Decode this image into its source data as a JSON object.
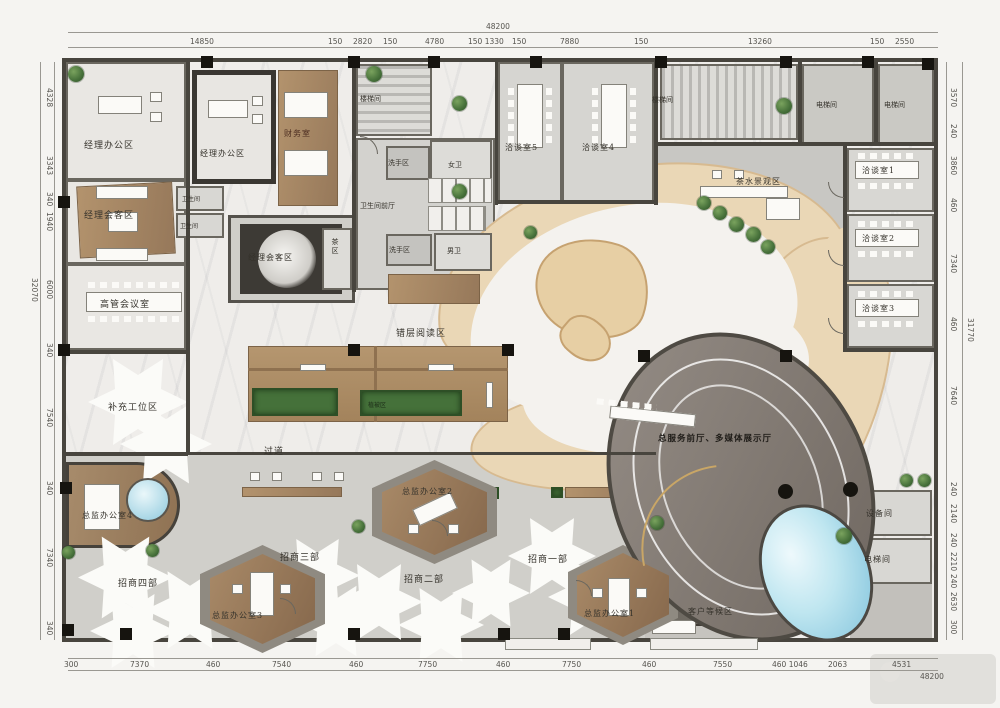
{
  "labels": {
    "manager_office_1": "经理办公区",
    "manager_office_2": "经理办公区",
    "finance_room": "财务室",
    "stair_left": "楼梯间",
    "wash_area_1": "洗手区",
    "womens_toilet": "女卫",
    "toilet_foyer": "卫生间前厅",
    "wash_area_2": "洗手区",
    "mens_toilet": "男卫",
    "meeting_room_5": "洽谈室5",
    "meeting_room_4": "洽谈室4",
    "stair_right": "楼梯间",
    "elevator_top_1": "电梯间",
    "elevator_top_2": "电梯间",
    "tea_landscape": "茶水景观区",
    "meeting_room_1": "洽谈室1",
    "meeting_room_2": "洽谈室2",
    "meeting_room_3": "洽谈室3",
    "manager_lounge_left": "经理会客区",
    "toilet_small_1": "卫生间",
    "toilet_small_2": "卫生间",
    "manager_lounge_center": "经理会客区",
    "tea_area": "茶区",
    "exec_meeting_room": "高管会议室",
    "reading_area": "错层阅读区",
    "vegetation": "植被区",
    "extra_workstations": "补充工位区",
    "corridor": "过道",
    "service_hall": "总服务前厅、多媒体展示厅",
    "director_office_4": "总监办公室4",
    "dept_4": "招商四部",
    "director_office_3": "总监办公室3",
    "dept_3": "招商三部",
    "director_office_2": "总监办公室2",
    "dept_2": "招商二部",
    "dept_1": "招商一部",
    "director_office_1": "总监办公室1",
    "waiting_area": "客户等候区",
    "equipment_room": "设备间",
    "elevator_bottom": "电梯间"
  },
  "dimensions": {
    "top": {
      "overall": "48200",
      "segments": [
        "14850",
        "150",
        "2820",
        "150",
        "4780",
        "150 1330",
        "150",
        "7880",
        "150",
        "13260",
        "150",
        "2550"
      ]
    },
    "bottom": {
      "overall": "48200",
      "segments": [
        "300",
        "7370",
        "460",
        "7540",
        "460",
        "7750",
        "460",
        "7750",
        "460",
        "7550",
        "460 1046",
        "2063",
        "4531"
      ]
    },
    "left": {
      "overall": "32070",
      "segments": [
        "4328",
        "3343",
        "340",
        "1940",
        "6000",
        "340",
        "7540",
        "340",
        "7340",
        "340"
      ]
    },
    "right": {
      "overall": "31770",
      "segments": [
        "3570",
        "240",
        "3860",
        "460",
        "7340",
        "460",
        "7640",
        "240",
        "2140",
        "240",
        "2210",
        "240",
        "2630",
        "300"
      ]
    }
  },
  "colors": {
    "wall": "#48453e",
    "wood": "#a8886a",
    "marble": "#efedea",
    "floor_gray": "#d3d2ce",
    "cream_band": "#ead7b6",
    "hall_gray": "#867e77",
    "pool_blue": "#9fd0e2",
    "plant_green": "#45713a"
  }
}
